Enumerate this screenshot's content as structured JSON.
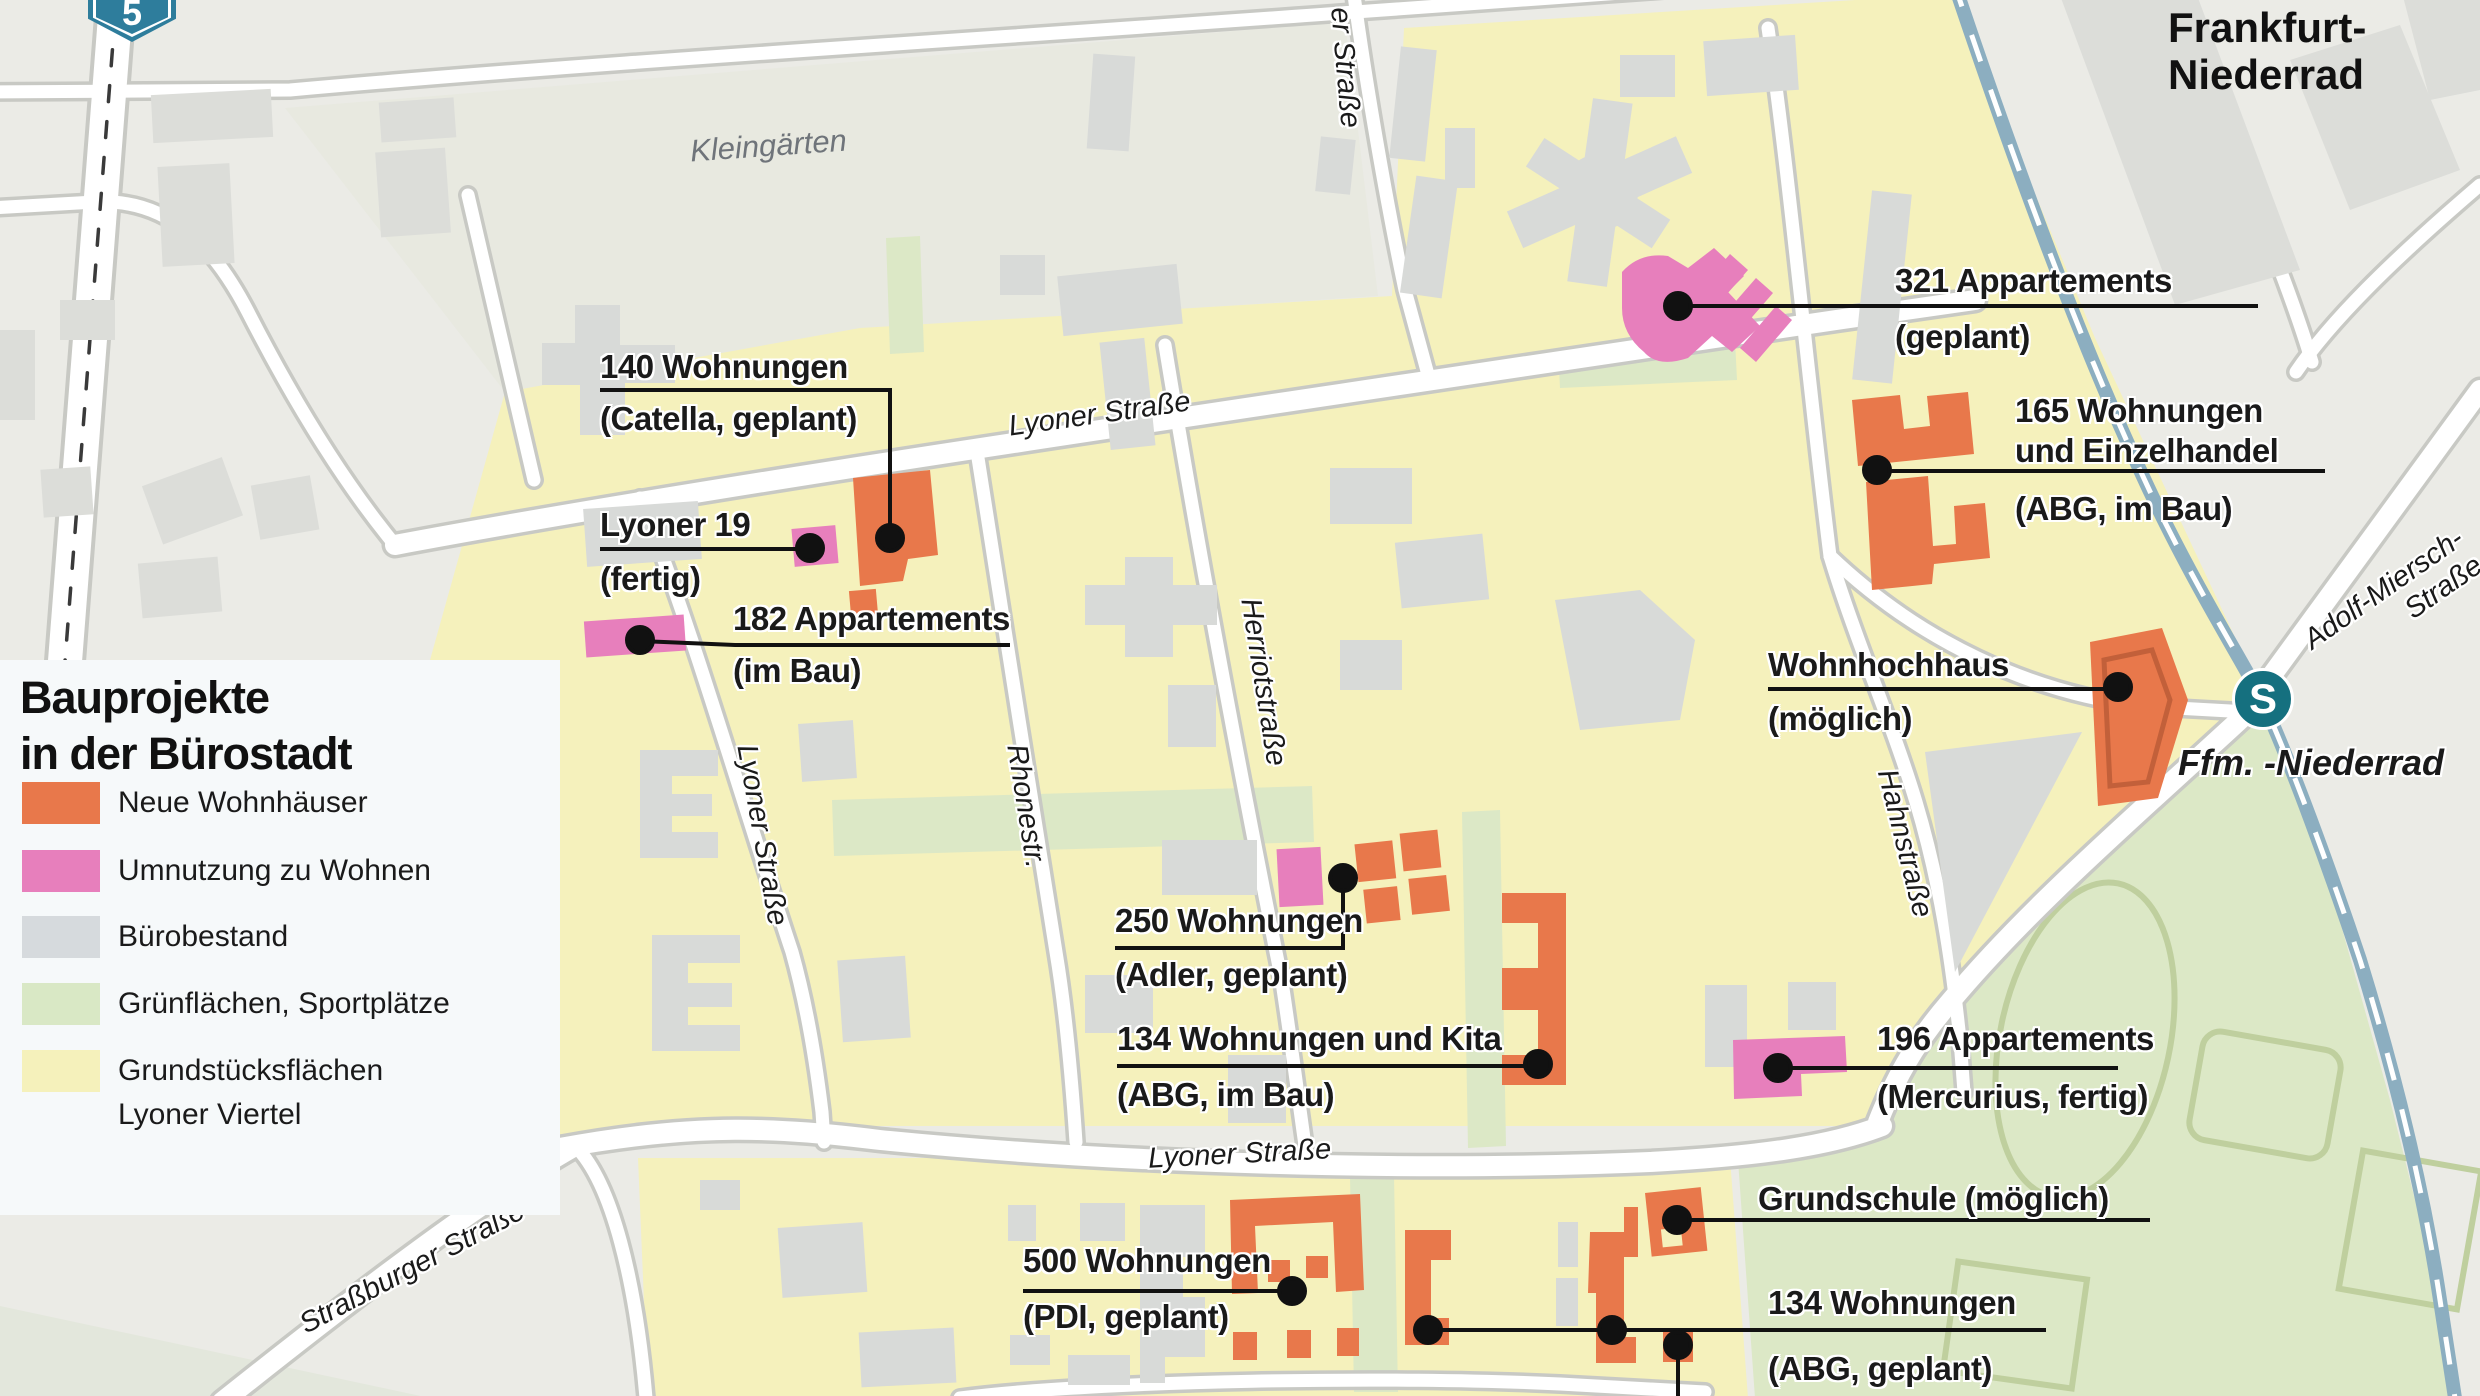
{
  "title": "Bauprojekte in der Bürostadt",
  "legend": {
    "title_line1": "Bauprojekte",
    "title_line2": "in der Bürostadt",
    "items": [
      {
        "label": "Neue Wohnhäuser",
        "color": "#E8784B"
      },
      {
        "label": "Umnutzung zu Wohnen",
        "color": "#E77FBC"
      },
      {
        "label": "Bürobestand",
        "color": "#D6DADD"
      },
      {
        "label": "Grünflächen, Sportplätze",
        "color": "#D9E8C5"
      },
      {
        "label": "Grundstücksflächen",
        "label_line2": "Lyoner Viertel",
        "color": "#F5F1BB"
      }
    ]
  },
  "annotations": {
    "catella": {
      "line1": "140 Wohnungen",
      "line2": "(Catella, geplant)"
    },
    "lyoner19": {
      "line1": "Lyoner 19",
      "line2": "(fertig)"
    },
    "app182": {
      "line1": "182 Appartements",
      "line2": "(im Bau)"
    },
    "app321": {
      "line1": "321 Appartements",
      "line2": "(geplant)"
    },
    "abg165": {
      "line1": "165 Wohnungen",
      "line2": "und Einzelhandel",
      "line3": "(ABG, im Bau)"
    },
    "wohnhochhaus": {
      "line1": "Wohnhochhaus",
      "line2": "(möglich)"
    },
    "adler250": {
      "line1": "250 Wohnungen",
      "line2": "(Adler, geplant)"
    },
    "kita134": {
      "line1": "134 Wohnungen und Kita",
      "line2": "(ABG, im Bau)"
    },
    "mercurius196": {
      "line1": "196 Appartements",
      "line2": "(Mercurius, fertig)"
    },
    "grundschule": {
      "line1": "Grundschule (möglich)"
    },
    "abg134": {
      "line1": "134 Wohnungen",
      "line2": "(ABG, geplant)"
    },
    "pdi500": {
      "line1": "500 Wohnungen",
      "line2": "(PDI, geplant)"
    }
  },
  "streets": {
    "lyoner_diag": "Lyoner Straße",
    "lyoner_left": "Lyoner Straße",
    "lyoner_bottom": "Lyoner Straße",
    "rhonestr": "Rhonestr.",
    "herriot": "Herriotstraße",
    "hahn": "Hahnstraße",
    "strassburger": "Straßburger Straße",
    "er_strasse": "er Straße",
    "adolf_line1": "Adolf-Miersch-",
    "adolf_line2": "Straße"
  },
  "places": {
    "kleingaerten": "Kleingärten",
    "city_line1": "Frankfurt-",
    "city_line2": "Niederrad",
    "sbahn_station": "Ffm. -Niederrad",
    "sbahn_letter": "S",
    "motorway_number": "5"
  },
  "colors": {
    "background": "#EBEBE6",
    "district_yellow": "#F5F1BC",
    "kleingaerten_area": "#E8E9E0",
    "green_area": "#DCE8C6",
    "building_gray": "#D8DAD8",
    "new_housing_orange": "#E8784B",
    "conversion_pink": "#E77FBC",
    "road_white": "#FFFFFF",
    "road_casing": "#C8C9C4",
    "railway_blue": "#8CAEC0",
    "sbahn_teal": "#15707F",
    "motorway_sign_blue": "#2E7D9C",
    "annotation_text": "#1A1A1A"
  }
}
